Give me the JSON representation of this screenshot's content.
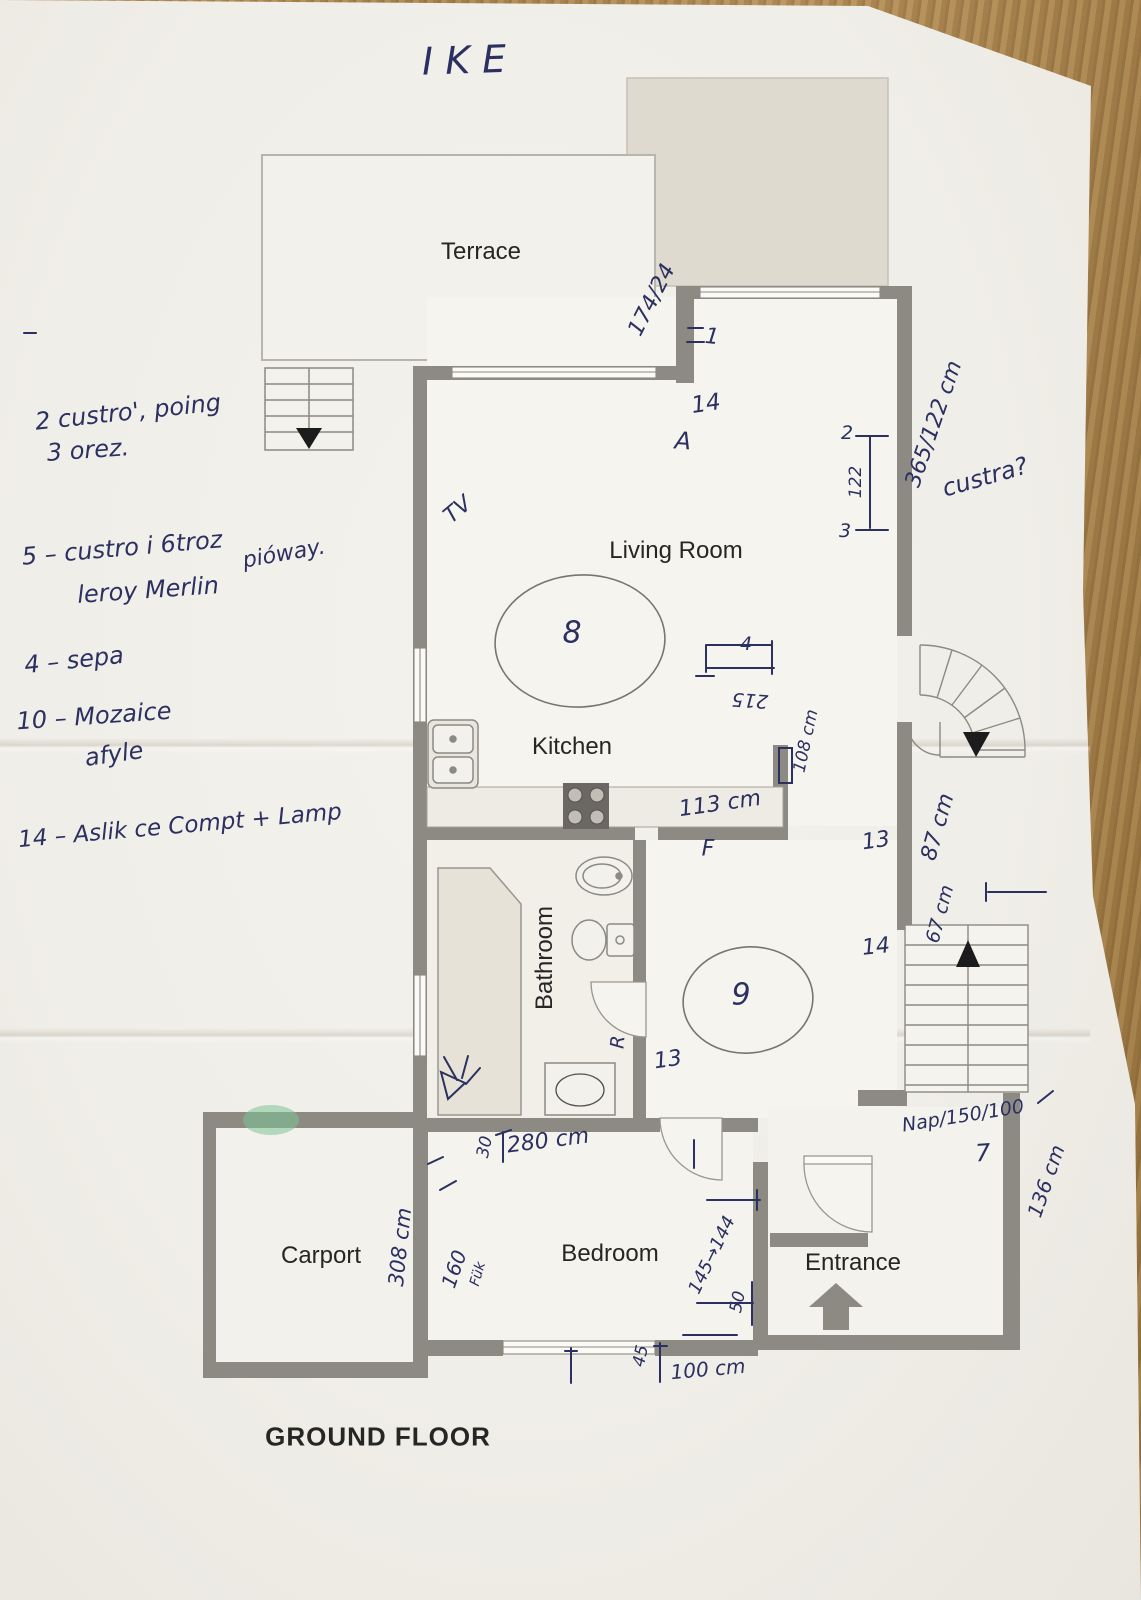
{
  "document": {
    "title_handwritten": "IKE",
    "floor_label": "GROUND FLOOR"
  },
  "rooms": {
    "terrace": "Terrace",
    "living_room": "Living Room",
    "kitchen": "Kitchen",
    "bathroom": "Bathroom",
    "bedroom": "Bedroom",
    "carport": "Carport",
    "entrance": "Entrance"
  },
  "handwritten_notes": {
    "note1": "2 custro', poing",
    "note2": "3 orez.",
    "note3": "5 – custro i 6troz",
    "note3b": "pióway.",
    "note4": "leroy Merlin",
    "note5": "4 – sepa",
    "note6": "10 – Mozaice",
    "note6b": "afyle",
    "note7": "14 – Aslik ce Compt + Lamp"
  },
  "handwritten_marks": {
    "tv": "TV",
    "dim_terrace": "174/24",
    "eq1": "1",
    "mark_14_lr": "14",
    "mark_A": "A",
    "circle_8": "8",
    "mark_2": "2",
    "dim_122": "122",
    "mark_3": "3",
    "dim_365_122": "365/122 cm",
    "q_custra": "custra?",
    "mark_4": "4",
    "dim_215": "215",
    "dim_113": "113 cm",
    "mark_F": "F",
    "dim_108": "108 cm",
    "mark_13_a": "13",
    "dim_87": "87 cm",
    "dim_67": "67 cm",
    "mark_14_b": "14",
    "circle_9": "9",
    "mark_13_b": "13",
    "mark_R": "R",
    "dim_nap": "Nap/150/100",
    "mark_7": "7",
    "dim_136": "136 cm",
    "dim_30": "30",
    "dim_280": "280 cm",
    "dim_160": "160",
    "mark_fuk": "Fük",
    "dim_308": "308 cm",
    "dim_145_144": "145→144",
    "dim_50": "50",
    "dim_45": "45",
    "dim_100": "100 cm"
  },
  "colors": {
    "paper": "#f1efe9",
    "wall_gray": "#8d8983",
    "beige_block": "#dedacf",
    "pen_ink": "#2b3060",
    "pencil": "#6e6e6c",
    "wood_table": "#ad8a58",
    "green_highlight": "#7ec498",
    "stair_arrow_black": "#1c1c1c"
  }
}
